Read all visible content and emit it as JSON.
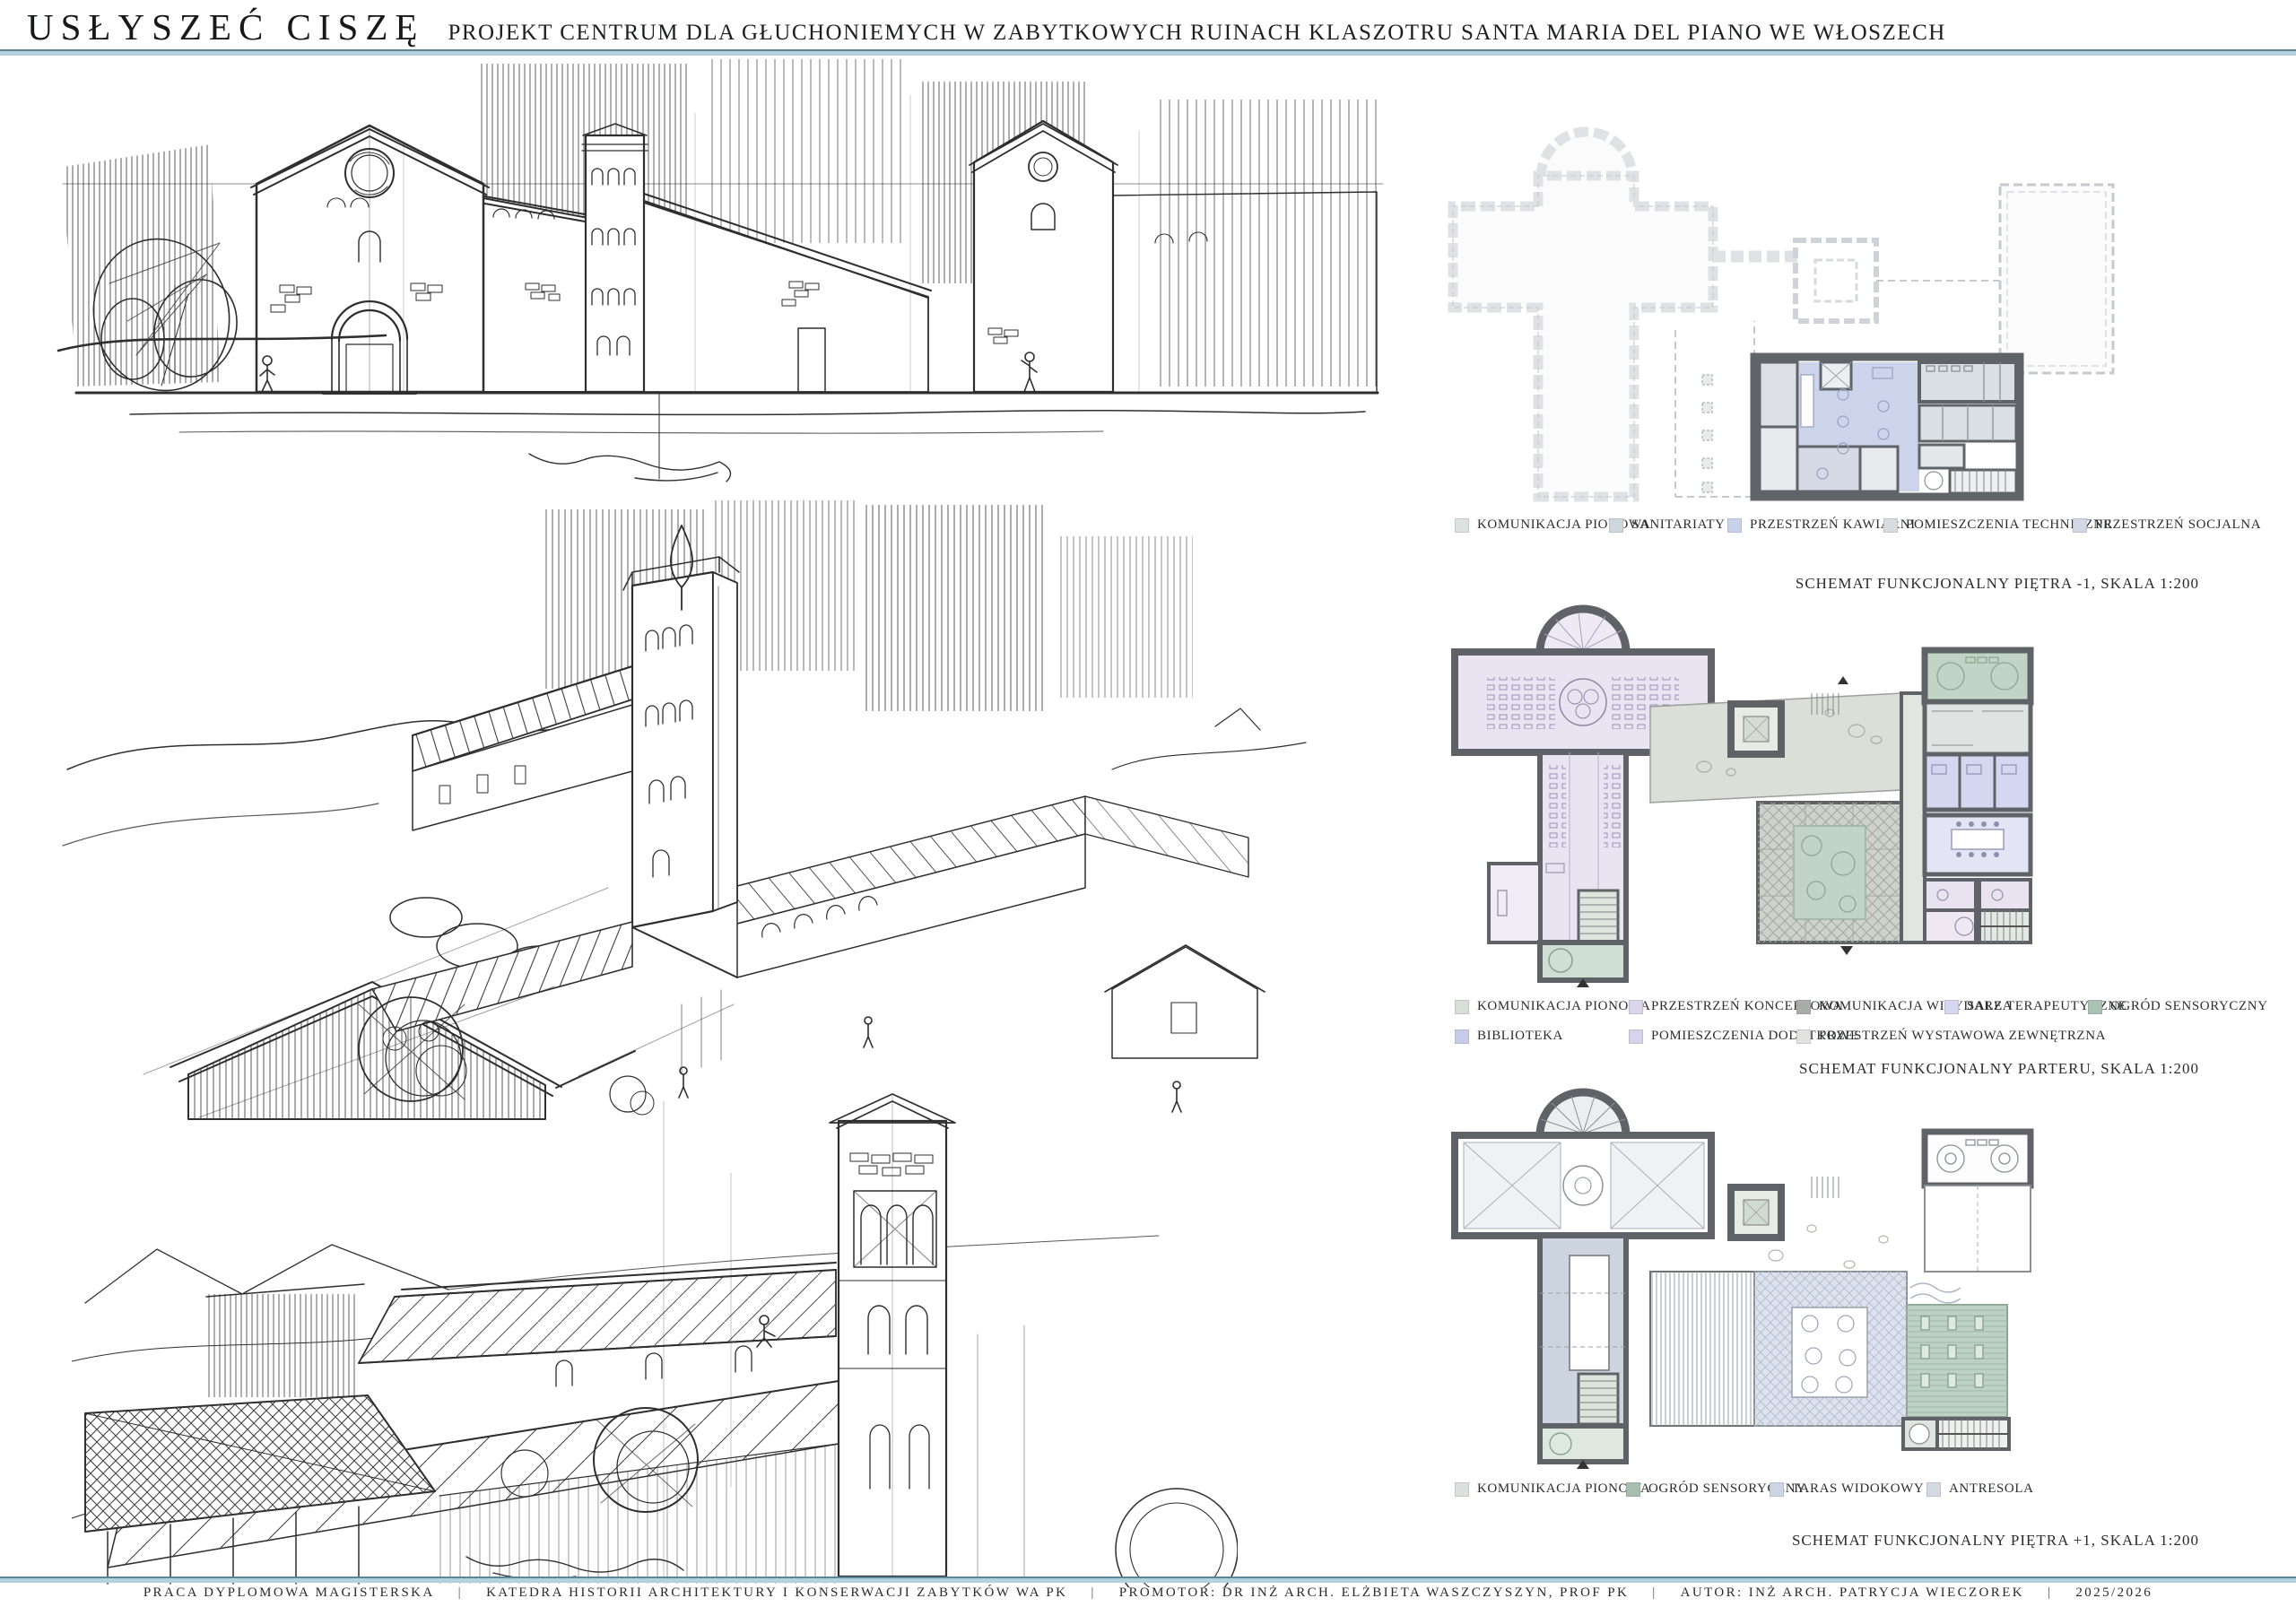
{
  "header": {
    "title": "USŁYSZEĆ CISZĘ",
    "subtitle": "PROJEKT CENTRUM DLA GŁUCHONIEMYCH W ZABYTKOWYCH RUINACH KLASZOTRU SANTA MARIA DEL PIANO WE WŁOSZECH"
  },
  "plans": [
    {
      "caption": "SCHEMAT FUNKCJONALNY PIĘTRA -1, SKALA 1:200",
      "legend": [
        {
          "label": "KOMUNIKACJA PIONOWA",
          "color": "#dce3dd"
        },
        {
          "label": "SANITARIATY",
          "color": "#cdd7dd"
        },
        {
          "label": "PRZESTRZEŃ KAWIARNI",
          "color": "#c9d2ec"
        },
        {
          "label": "POMIESZCZENIA TECHNICZNE",
          "color": "#d8dce0"
        },
        {
          "label": "PRZESTRZEŃ SOCJALNA",
          "color": "#d2d7e4"
        }
      ]
    },
    {
      "caption": "SCHEMAT FUNKCJONALNY PARTERU, SKALA 1:200",
      "legend": [
        {
          "label": "KOMUNIKACJA PIONOWA",
          "color": "#d7e0d8"
        },
        {
          "label": "PRZESTRZEŃ KONCERTOWA",
          "color": "#dbd5ec"
        },
        {
          "label": "KOMUNIKACJA WIRYDARZA",
          "color": "#a8adaa"
        },
        {
          "label": "SALE TERAPEUTYCZNE",
          "color": "#d5d7f0"
        },
        {
          "label": "OGRÓD SENSORYCZNY",
          "color": "#a9c2b1"
        },
        {
          "label": "BIBLIOTEKA",
          "color": "#c6cdea"
        },
        {
          "label": "POMIESZCZENIA DODATKOWE",
          "color": "#d8d3ee"
        },
        {
          "label": "PRZESTRZEŃ WYSTAWOWA ZEWNĘTRZNA",
          "color": "#e1e2df"
        }
      ]
    },
    {
      "caption": "SCHEMAT FUNKCJONALNY PIĘTRA +1, SKALA 1:200",
      "legend": [
        {
          "label": "KOMUNIKACJA PIONOWA",
          "color": "#dbe2db"
        },
        {
          "label": "OGRÓD SENSORYCZNY",
          "color": "#a6beac"
        },
        {
          "label": "TARAS WIDOKOWY",
          "color": "#cbd5e6"
        },
        {
          "label": "ANTRESOLA",
          "color": "#d4dae3"
        }
      ]
    }
  ],
  "footer": {
    "separator": "|",
    "items": [
      "PRACA DYPLOMOWA MAGISTERSKA",
      "KATEDRA HISTORII ARCHITEKTURY I  KONSERWACJI ZABYTKÓW WA PK",
      "PROMOTOR: DR INŻ ARCH. ELŻBIETA WASZCZYSZYN, PROF PK",
      "AUTOR: INŻ ARCH. PATRYCJA WIECZOREK",
      "2025/2026"
    ]
  }
}
